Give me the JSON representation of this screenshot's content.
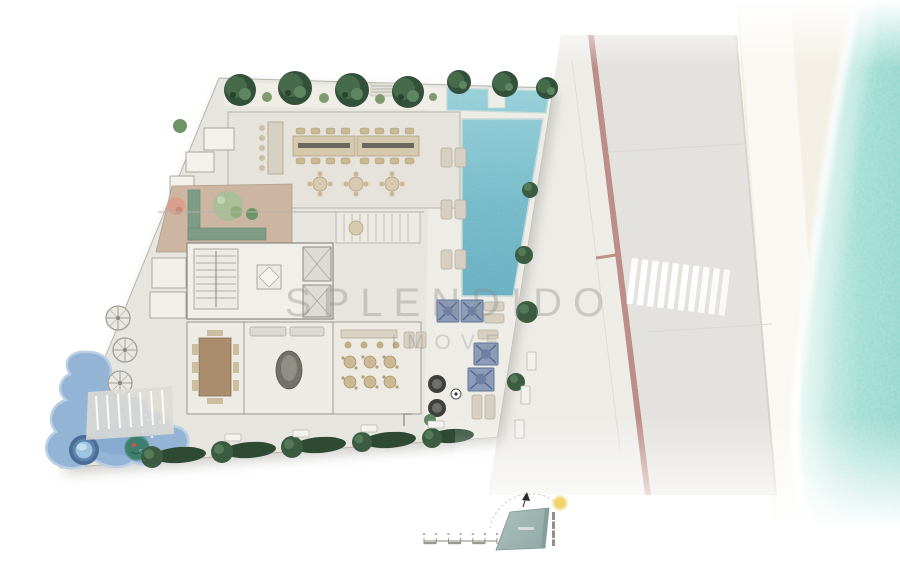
{
  "watermark": {
    "line1": "SPLENDIDO",
    "line2": "IMOVE"
  },
  "palette": {
    "background": "#ffffff",
    "site_floor": "#e7e5df",
    "pool_deck": "#edece6",
    "pool_water": "#6fb9c9",
    "kids_pool": "#94b4d6",
    "spa_ring_blue": "#4a6d96",
    "sea_water": "#9ddcd1",
    "sea_foam": "#ffffff",
    "sand": "#f3efe4",
    "boardwalk": "#faf8f2",
    "road": "#e3e2df",
    "sidewalk": "#edece7",
    "bike_lane_line": "#b27a72",
    "crosswalk_stripe": "#ffffff",
    "tree_green": "#33503a",
    "hedge_green": "#2e4a33",
    "planter_green": "#7e9c86",
    "garden_floor": "#ccb6a2",
    "furniture_tan": "#cbb894",
    "cabana_blue": "#8b9cb8",
    "wall_gray": "#9a988f",
    "watermark_gray": "#8a8a8a",
    "locator_teal": "#9eb5b2",
    "sun_yellow": "#f0d268",
    "north_arrow_black": "#2b2b28"
  },
  "icons": {
    "north-arrow-icon": "▲",
    "sun-icon": "☀",
    "parasol-icon": "✛",
    "elevator-x-icon": "✕"
  }
}
